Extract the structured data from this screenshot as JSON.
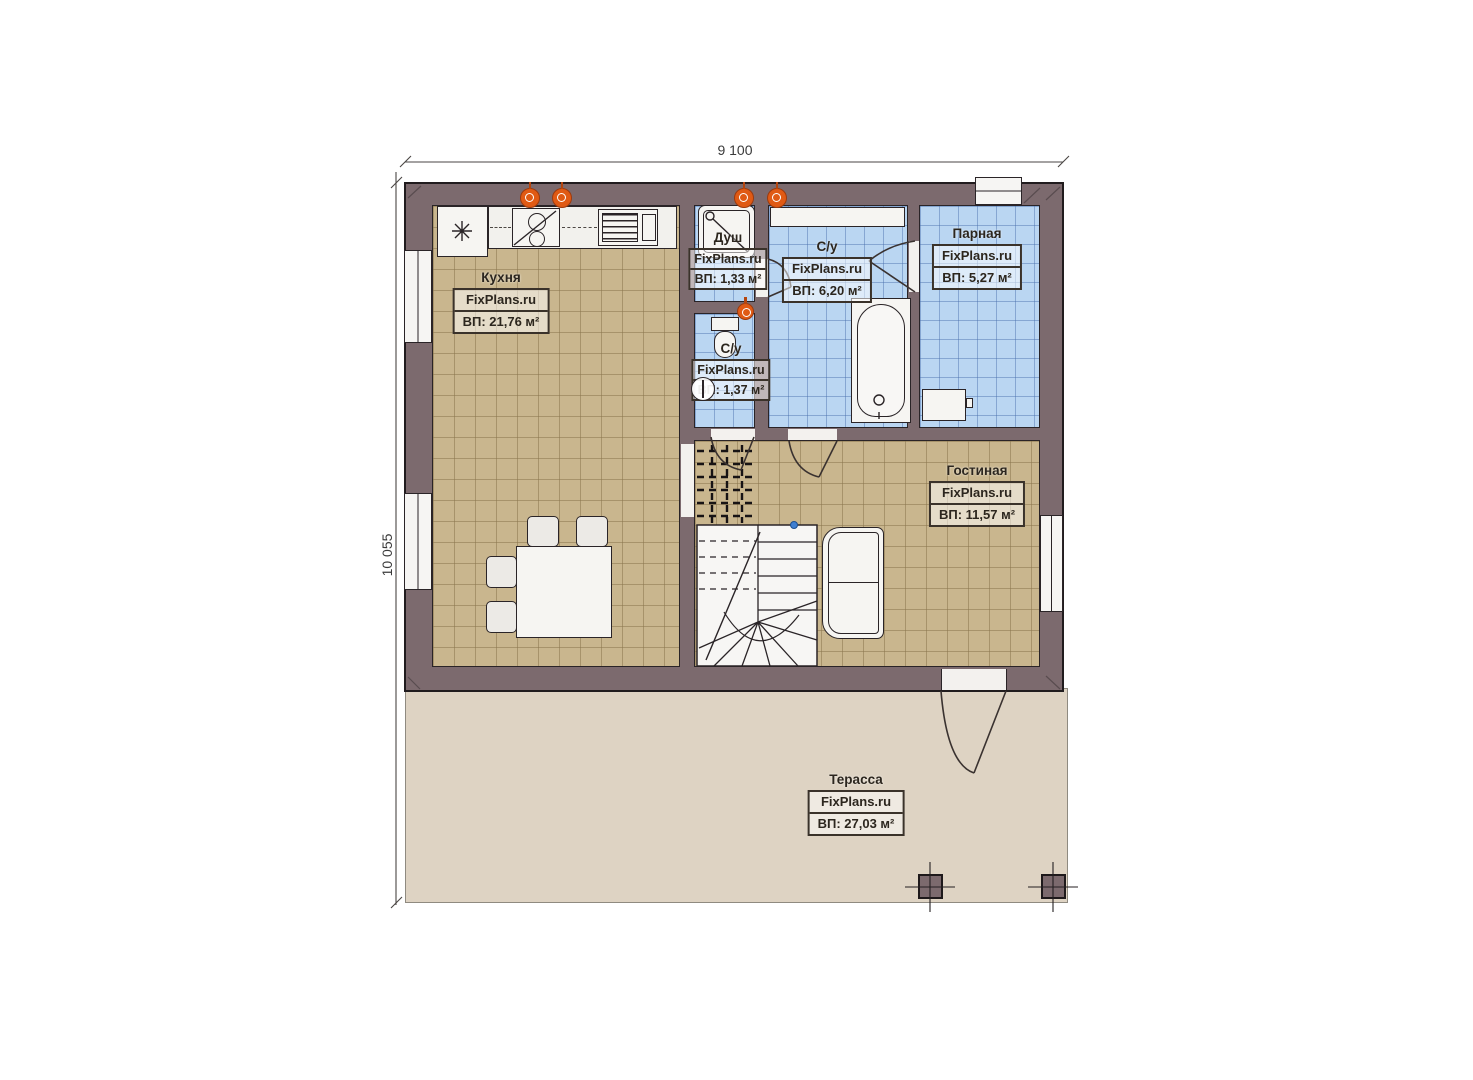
{
  "watermark": "FixPlans.ru",
  "dimensions": {
    "width": "9 100",
    "height": "10 055"
  },
  "rooms": {
    "kitchen": {
      "name": "Кухня",
      "area": "ВП: 21,76 м²"
    },
    "shower": {
      "name": "Душ",
      "area": "ВП: 1,33 м²"
    },
    "bathroom": {
      "name": "С/у",
      "area": "ВП: 6,20 м²"
    },
    "steam_room": {
      "name": "Парная",
      "area": "ВП: 5,27 м²"
    },
    "wc": {
      "name": "С/у",
      "area": "ВП: 1,37 м²"
    },
    "living_room": {
      "name": "Гостиная",
      "area": "ВП: 11,57 м²"
    },
    "terrace": {
      "name": "Терасса",
      "area": "ВП: 27,03 м²"
    }
  },
  "colors": {
    "wall": "#7c6a6e",
    "floor_wood": "#c9b68e",
    "floor_tile": "#bad6f2",
    "terrace": "#ded3c3",
    "accent_orange": "#e05a14"
  }
}
